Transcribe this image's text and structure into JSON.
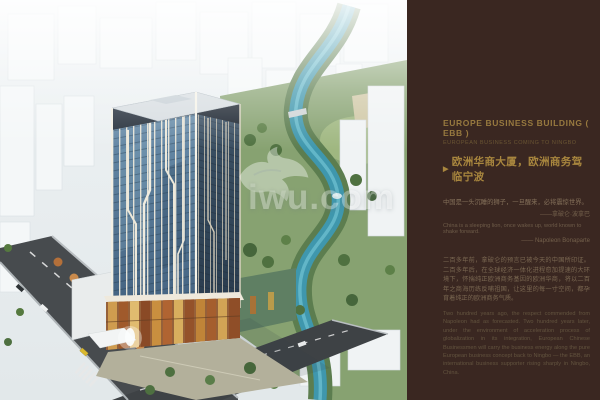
{
  "canvas": {
    "width": 600,
    "height": 400
  },
  "colors": {
    "panel_bg": "#3A2721",
    "gold_title": "#A8863E",
    "gold_text": "#97793F",
    "muted_text": "#7B6852",
    "river_teal": "#3F97AD",
    "glass_blue": "#4E6F8E",
    "park_green": "#87A271"
  },
  "rendering": {
    "watermark_text": "iwu.com"
  },
  "panel": {
    "title_en": "EUROPE BUSINESS BUILDING ( EBB )",
    "subtitle_en": "EUROPEAN BUSINESS COMING TO NINGBO",
    "arrow": "▶",
    "title_cn": "欧洲华商大厦，欧洲商务驾临宁波",
    "quote_cn": "中国是一头沉睡的狮子，一旦醒来，必将震惊世界。",
    "quote_cn_attr": "——拿破仑·波拿巴",
    "quote_en": "China is a sleeping lion, once wakes up, world known to shake forward.",
    "quote_en_attr": "—— Napoleon Bonaparte",
    "para_cn": "二百多年前，拿破仑的预言已被今天的中国所印证。二百多年后，在全球经济一体化进程愈加提速的大环境下，怀揣纯正欧洲商务基因的欧洲华商，将以二百年之商海历练反哺祖国，让这里的每一寸空间，都孕育着纯正的欧洲商务气质。",
    "para_en": "Two hundred years ago, the respect commended from Napoleon had as forecasted. Two hundred years later, under the environment of acceleration process of globalization in its integration, European Chinese Businessmen will carry the business energy along the pure European business concept back to Ningbo — the EBB, an international business supporter rising sharply in Ningbo, China."
  }
}
